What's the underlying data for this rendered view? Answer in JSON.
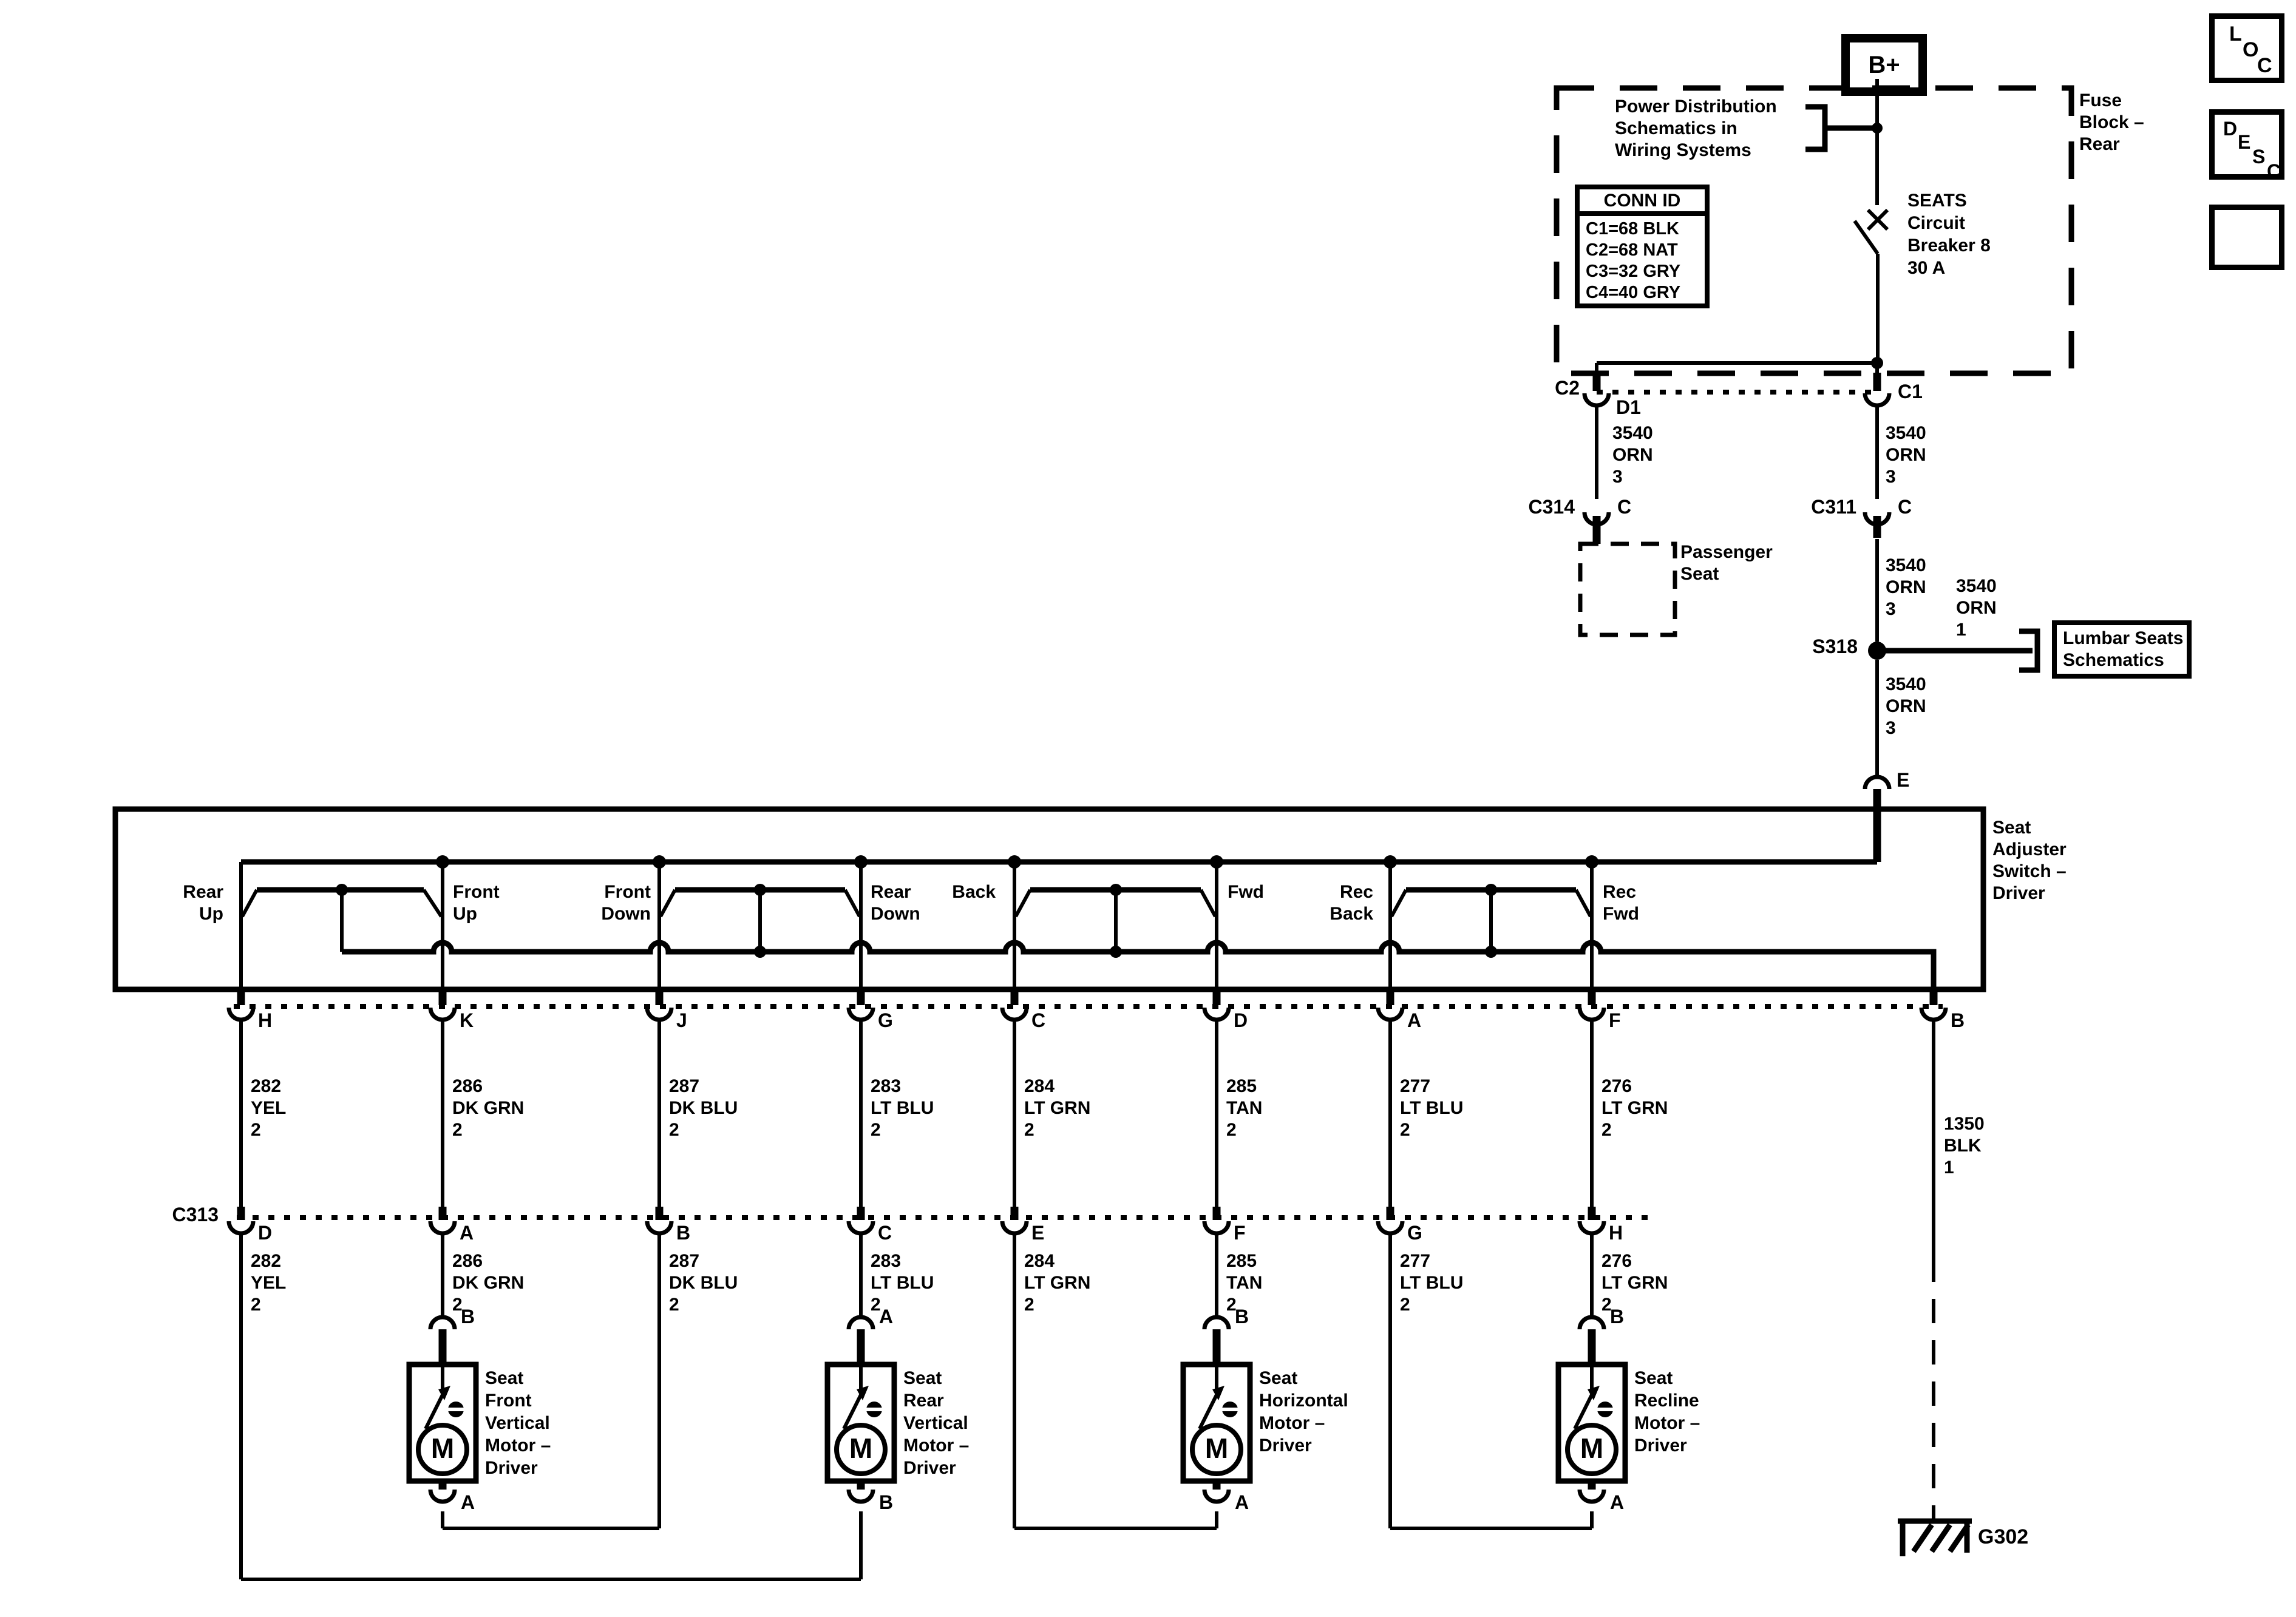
{
  "colors": {
    "ink": "#000000",
    "paper": "#ffffff"
  },
  "corner_icons": {
    "loc": [
      "L",
      "O",
      "C"
    ],
    "desc": [
      "D",
      "E",
      "S",
      "C"
    ]
  },
  "power": {
    "battery": "B+",
    "fuse_block_label": "Fuse\nBlock –\nRear",
    "power_dist_note": "Power Distribution\nSchematics in\nWiring Systems",
    "conn_id": {
      "title": "CONN ID",
      "rows": "C1=68 BLK\nC2=68 NAT\nC3=32 GRY\nC4=40 GRY"
    },
    "breaker_label": "SEATS\nCircuit\nBreaker 8\n30 A"
  },
  "connectors": {
    "c2": "C2",
    "c2_pin": "D1",
    "c1": "C1",
    "c314": "C314",
    "c314_pin": "C",
    "c311": "C311",
    "c311_pin": "C",
    "s318": "S318",
    "e_pin": "E",
    "c313": "C313",
    "b_pin": "B"
  },
  "wires": {
    "orn_c2": "3540\nORN\n3",
    "orn_c1": "3540\nORN\n3",
    "orn_mid": "3540\nORN\n3",
    "orn_low": "3540\nORN\n3",
    "orn_lumbar": "3540\nORN\n1",
    "blk": "1350\nBLK\n1",
    "row": [
      "282\nYEL\n2",
      "286\nDK GRN\n2",
      "287\nDK BLU\n2",
      "283\nLT BLU\n2",
      "284\nLT GRN\n2",
      "285\nTAN\n2",
      "277\nLT BLU\n2",
      "276\nLT GRN\n2"
    ]
  },
  "passenger_seat": "Passenger\nSeat",
  "lumbar_box": "Lumbar Seats\nSchematics",
  "switch": {
    "title": "Seat\nAdjuster\nSwitch –\nDriver",
    "positions": [
      "Rear\nUp",
      "Front\nUp",
      "Front\nDown",
      "Rear\nDown",
      "Back",
      "Fwd",
      "Rec\nBack",
      "Rec\nFwd"
    ],
    "pins_row": [
      "H",
      "K",
      "J",
      "G",
      "C",
      "D",
      "A",
      "F",
      "B"
    ]
  },
  "c313_pins": [
    "D",
    "A",
    "B",
    "C",
    "E",
    "F",
    "G",
    "H"
  ],
  "motors": [
    {
      "label": "Seat\nFront\nVertical\nMotor –\nDriver",
      "top_pin": "B",
      "bottom_pin": "A",
      "symbol": "M"
    },
    {
      "label": "Seat\nRear\nVertical\nMotor –\nDriver",
      "top_pin": "A",
      "bottom_pin": "B",
      "symbol": "M"
    },
    {
      "label": "Seat\nHorizontal\nMotor –\nDriver",
      "top_pin": "B",
      "bottom_pin": "A",
      "symbol": "M"
    },
    {
      "label": "Seat\nRecline\nMotor –\nDriver",
      "top_pin": "B",
      "bottom_pin": "A",
      "symbol": "M"
    }
  ],
  "ground": {
    "id": "G302"
  }
}
